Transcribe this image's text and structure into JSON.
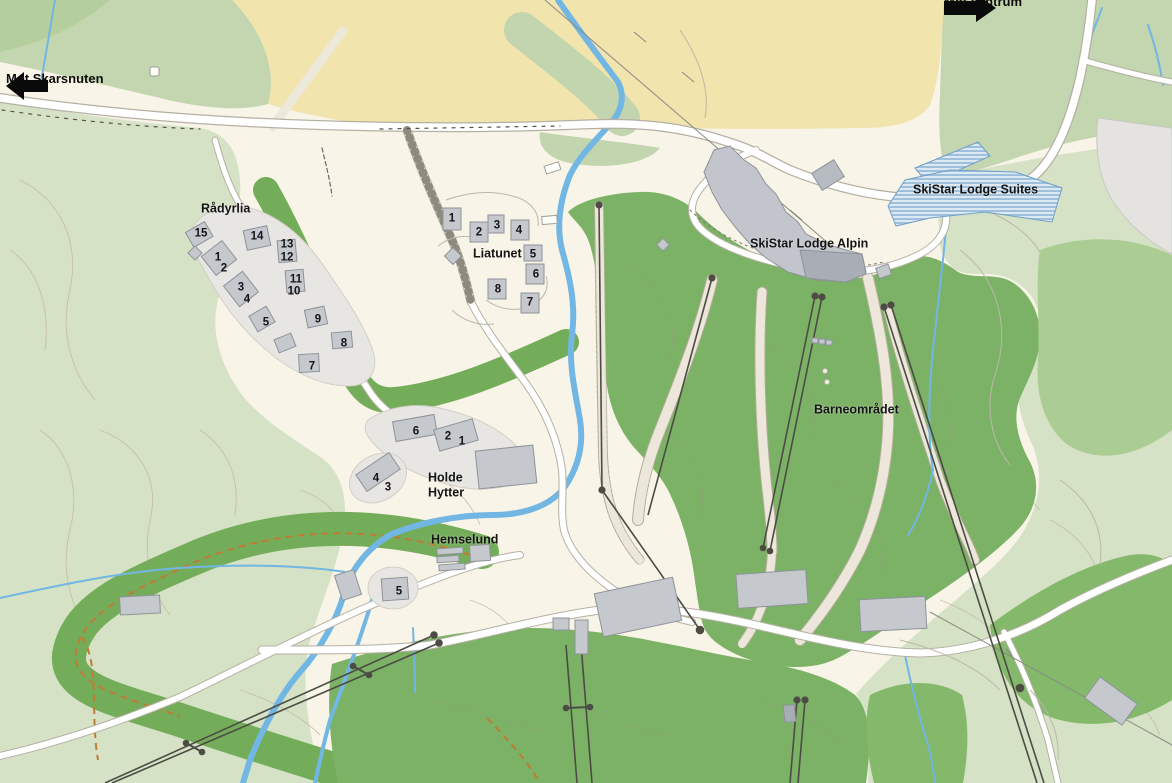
{
  "map": {
    "description": "Ski resort village map",
    "palette": {
      "base_cream": "#f8f4e7",
      "farmland_yellow": "#f2e4ad",
      "pale_green": "#d5e2c6",
      "sage_green": "#c3d6af",
      "forest_green": "#7cb266",
      "rock_gray": "#e4e3e0",
      "plot_gray": "#e7e6e2",
      "building_gray": "#c5c9ce",
      "river_blue": "#72b6e4",
      "road_white": "#ffffff",
      "lift_dark": "#4c4c44",
      "track_orange": "#c07b35",
      "construction_hatch_blue": "#9fc0dc",
      "label_black": "#151515"
    }
  },
  "direction_signs": [
    {
      "id": "skarsnuten",
      "label": "Mot Skarsnuten",
      "direction": "left"
    },
    {
      "id": "sentrum",
      "label": "Mot sentrum",
      "direction": "right"
    }
  ],
  "area_labels": [
    {
      "id": "radyrlia",
      "text": "Rådyrlia",
      "x": 201,
      "y": 209
    },
    {
      "id": "liatunet",
      "text": "Liatunet",
      "x": 473,
      "y": 254
    },
    {
      "id": "skistar-lodge-suites",
      "text": "SkiStar Lodge Suites",
      "x": 913,
      "y": 190
    },
    {
      "id": "skistar-lodge-alpin",
      "text": "SkiStar Lodge Alpin",
      "x": 750,
      "y": 244
    },
    {
      "id": "barneomradet",
      "text": "Barneområdet",
      "x": 814,
      "y": 410
    },
    {
      "id": "holde-hytter",
      "text": "Holde\nHytter",
      "x": 428,
      "y": 485
    },
    {
      "id": "hemselund",
      "text": "Hemselund",
      "x": 431,
      "y": 540
    }
  ],
  "markers": {
    "radyrlia": [
      {
        "n": "15",
        "x": 201,
        "y": 234
      },
      {
        "n": "14",
        "x": 257,
        "y": 237
      },
      {
        "n": "13",
        "x": 287,
        "y": 245
      },
      {
        "n": "12",
        "x": 287,
        "y": 258
      },
      {
        "n": "1",
        "x": 218,
        "y": 258
      },
      {
        "n": "2",
        "x": 224,
        "y": 269
      },
      {
        "n": "11",
        "x": 296,
        "y": 280
      },
      {
        "n": "10",
        "x": 294,
        "y": 292
      },
      {
        "n": "3",
        "x": 241,
        "y": 288
      },
      {
        "n": "4",
        "x": 247,
        "y": 300
      },
      {
        "n": "9",
        "x": 318,
        "y": 320
      },
      {
        "n": "5",
        "x": 266,
        "y": 323
      },
      {
        "n": "8",
        "x": 344,
        "y": 344
      },
      {
        "n": "7",
        "x": 312,
        "y": 367
      }
    ],
    "liatunet": [
      {
        "n": "1",
        "x": 452,
        "y": 219
      },
      {
        "n": "2",
        "x": 479,
        "y": 233
      },
      {
        "n": "3",
        "x": 497,
        "y": 226
      },
      {
        "n": "4",
        "x": 519,
        "y": 231
      },
      {
        "n": "5",
        "x": 533,
        "y": 255
      },
      {
        "n": "6",
        "x": 536,
        "y": 275
      },
      {
        "n": "8",
        "x": 498,
        "y": 290
      },
      {
        "n": "7",
        "x": 530,
        "y": 303
      }
    ],
    "holde_hytter": [
      {
        "n": "6",
        "x": 416,
        "y": 432
      },
      {
        "n": "2",
        "x": 448,
        "y": 437
      },
      {
        "n": "1",
        "x": 462,
        "y": 442
      },
      {
        "n": "4",
        "x": 376,
        "y": 479
      },
      {
        "n": "3",
        "x": 388,
        "y": 488
      }
    ],
    "hemselund": [
      {
        "n": "5",
        "x": 399,
        "y": 592
      }
    ]
  }
}
